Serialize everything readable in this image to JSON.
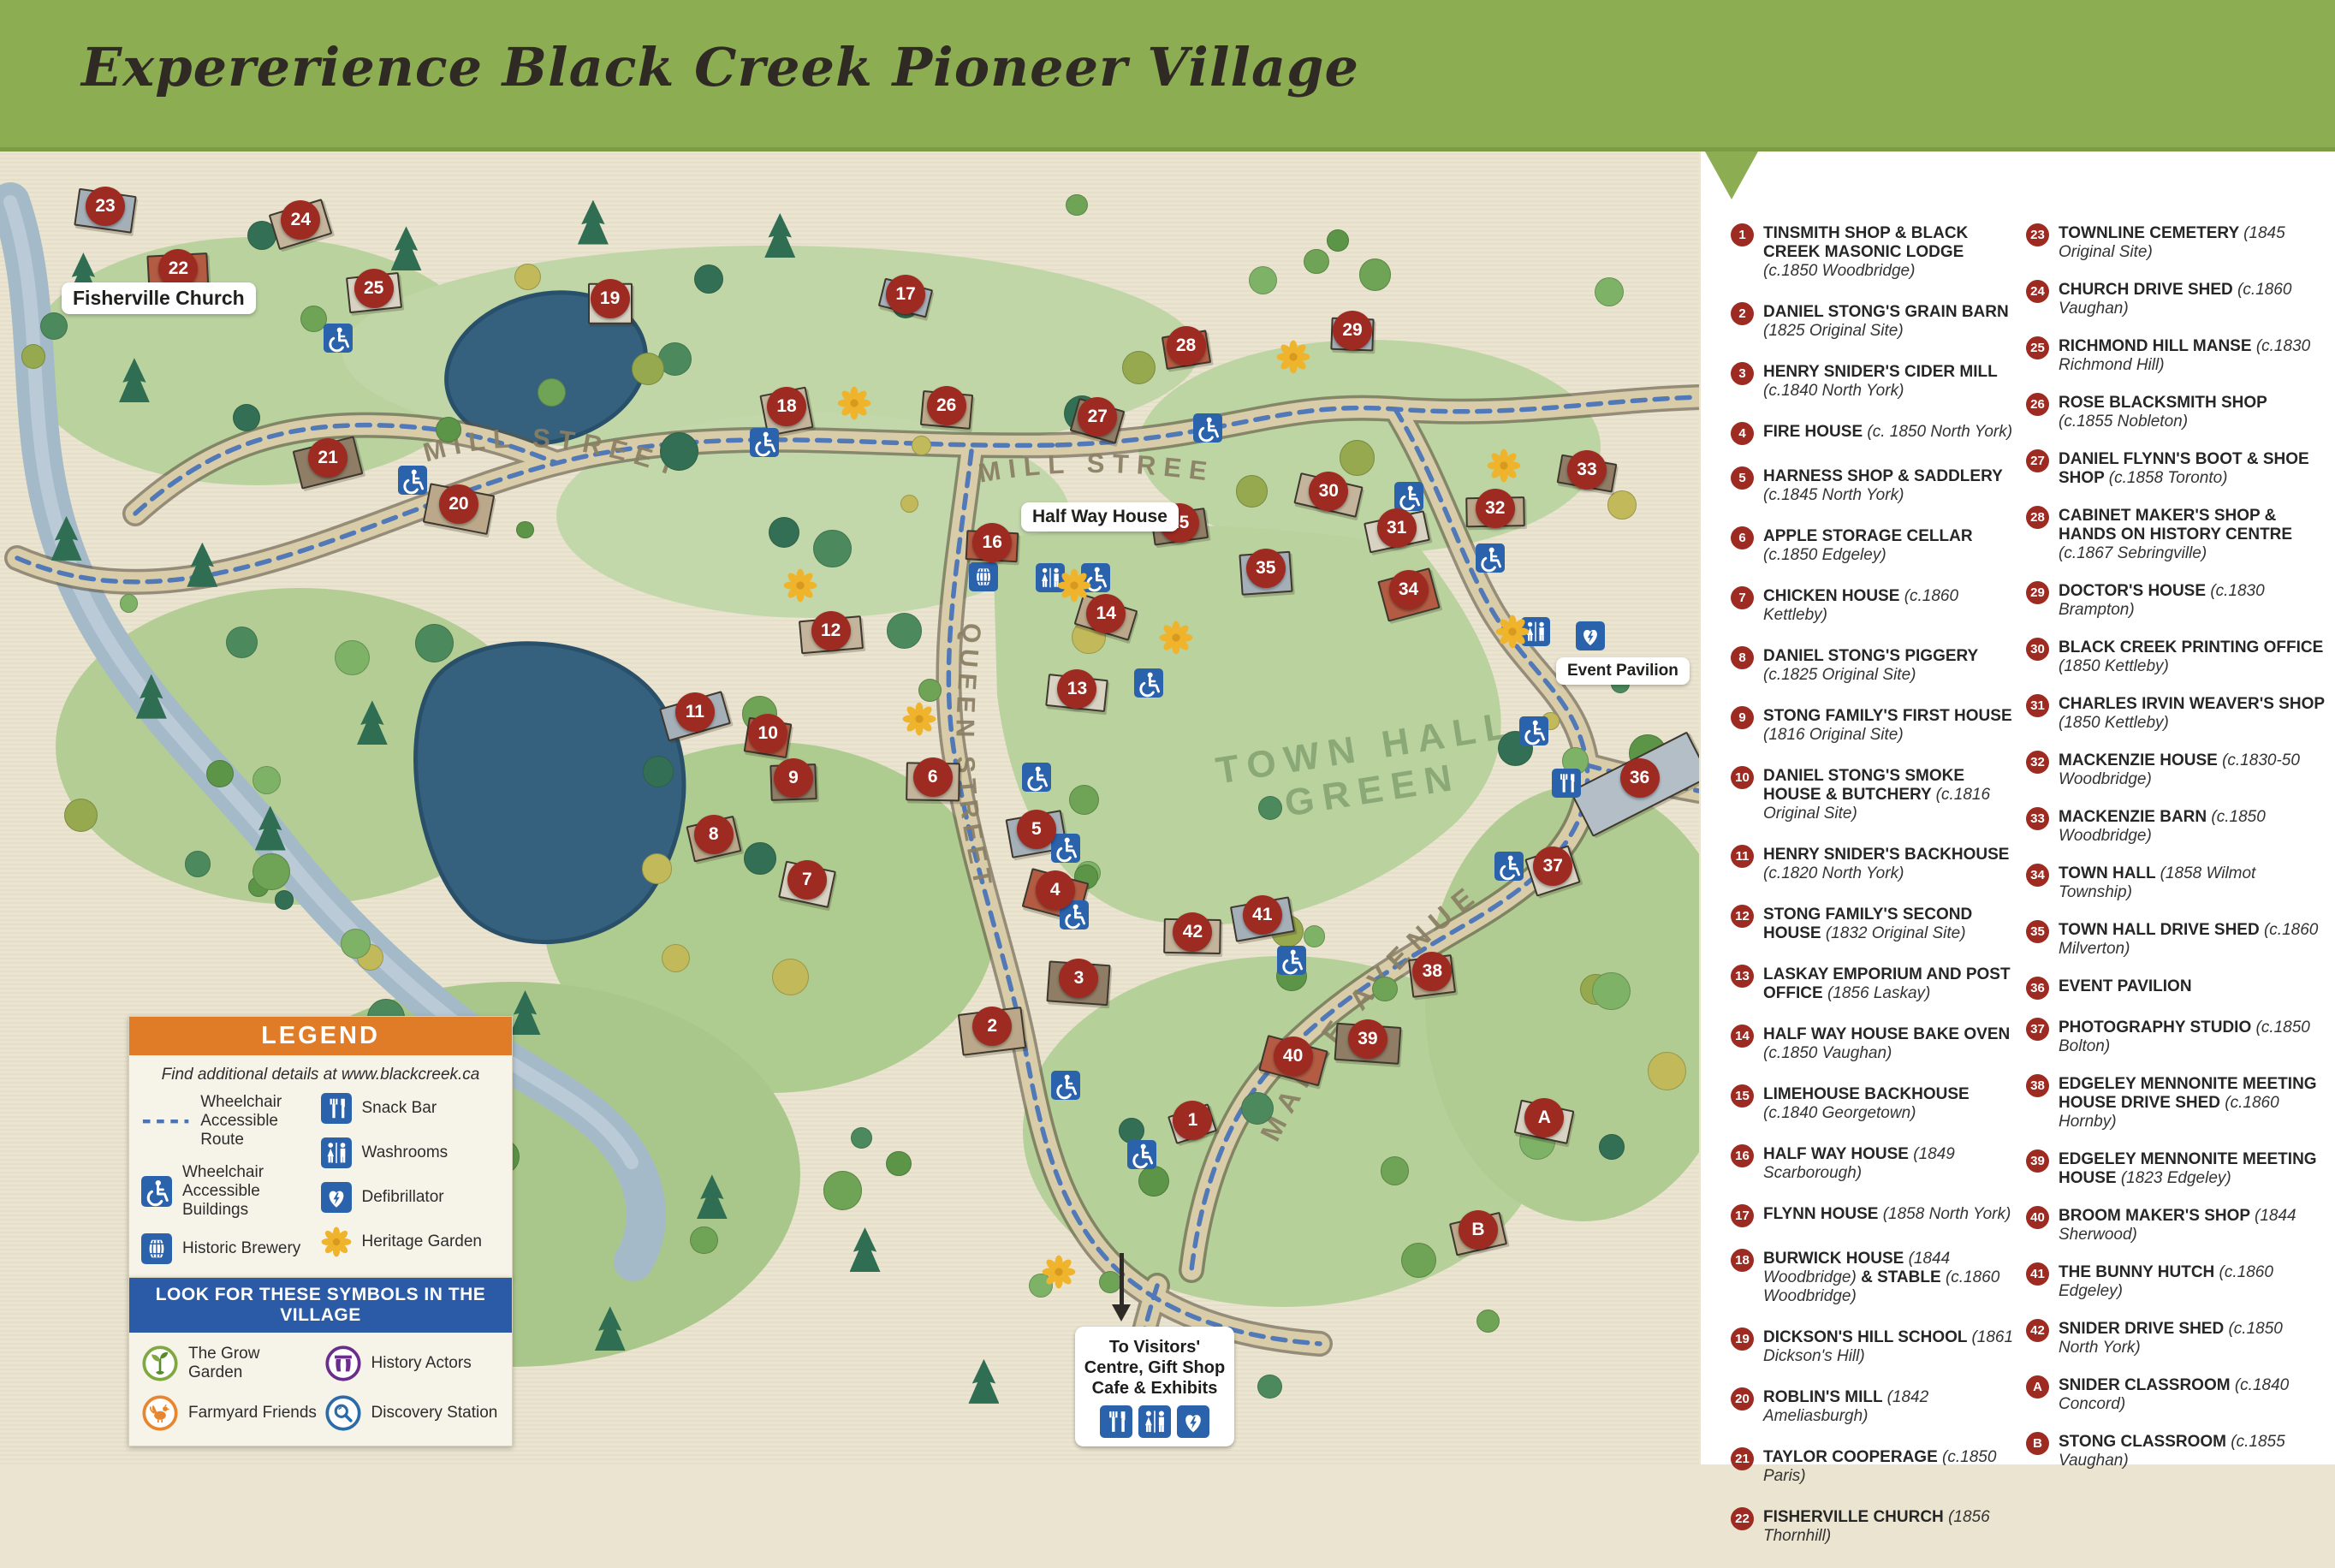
{
  "title": "Expererience Black Creek Pioneer Village",
  "colors": {
    "header_green": "#8CAD52",
    "marker_red": "#9E2B22",
    "icon_blue": "#2B62AC",
    "route_blue": "#4A74B8",
    "legend_orange": "#E07B27",
    "symbols_blue": "#2B5BA7",
    "heritage_yellow": "#EFB42C",
    "map_cream": "#EAE4D0",
    "road_tan": "#D9CDA9",
    "pond_blue": "#35617F",
    "river_blue": "#A4BAC9"
  },
  "map": {
    "streets": {
      "mill_left": "MILL STREET",
      "mill_center": "MILL STREET",
      "queen": "QUEEN STREET",
      "maple": "MAPLE AVENUE"
    },
    "green_label": [
      "TOWN HALL",
      "GREEN"
    ],
    "callouts": {
      "fisherville": "Fisherville Church",
      "halfway": "Half Way House",
      "event": "Event Pavilion"
    },
    "visitor_sign": {
      "lines": [
        "To Visitors'",
        "Centre, Gift Shop",
        "Cafe & Exhibits"
      ],
      "icons": [
        "snackbar",
        "washroom",
        "defib"
      ]
    },
    "markers": [
      {
        "id": "1",
        "x": 70.2,
        "y": 73.9
      },
      {
        "id": "2",
        "x": 58.4,
        "y": 66.7
      },
      {
        "id": "3",
        "x": 63.5,
        "y": 63.1
      },
      {
        "id": "4",
        "x": 62.1,
        "y": 56.4
      },
      {
        "id": "5",
        "x": 61.0,
        "y": 51.8
      },
      {
        "id": "6",
        "x": 54.9,
        "y": 47.8
      },
      {
        "id": "7",
        "x": 47.5,
        "y": 55.6
      },
      {
        "id": "8",
        "x": 42.0,
        "y": 52.2
      },
      {
        "id": "9",
        "x": 46.7,
        "y": 47.9
      },
      {
        "id": "10",
        "x": 45.2,
        "y": 44.5
      },
      {
        "id": "11",
        "x": 40.9,
        "y": 42.9
      },
      {
        "id": "12",
        "x": 48.9,
        "y": 36.7
      },
      {
        "id": "13",
        "x": 63.4,
        "y": 41.1
      },
      {
        "id": "14",
        "x": 65.1,
        "y": 35.4
      },
      {
        "id": "15",
        "x": 69.4,
        "y": 28.5
      },
      {
        "id": "16",
        "x": 58.4,
        "y": 30.0
      },
      {
        "id": "17",
        "x": 53.3,
        "y": 11.2
      },
      {
        "id": "18",
        "x": 46.3,
        "y": 19.7
      },
      {
        "id": "19",
        "x": 35.9,
        "y": 11.5
      },
      {
        "id": "20",
        "x": 27.0,
        "y": 27.1
      },
      {
        "id": "21",
        "x": 19.3,
        "y": 23.6
      },
      {
        "id": "22",
        "x": 10.5,
        "y": 9.2
      },
      {
        "id": "23",
        "x": 6.2,
        "y": 4.5
      },
      {
        "id": "24",
        "x": 17.7,
        "y": 5.5
      },
      {
        "id": "25",
        "x": 22.0,
        "y": 10.7
      },
      {
        "id": "26",
        "x": 55.7,
        "y": 19.6
      },
      {
        "id": "27",
        "x": 64.6,
        "y": 20.5
      },
      {
        "id": "28",
        "x": 69.8,
        "y": 15.1
      },
      {
        "id": "29",
        "x": 79.6,
        "y": 13.9
      },
      {
        "id": "30",
        "x": 78.2,
        "y": 26.1
      },
      {
        "id": "31",
        "x": 82.2,
        "y": 28.9
      },
      {
        "id": "32",
        "x": 88.0,
        "y": 27.4
      },
      {
        "id": "33",
        "x": 93.4,
        "y": 24.5
      },
      {
        "id": "34",
        "x": 82.9,
        "y": 33.6
      },
      {
        "id": "35",
        "x": 74.5,
        "y": 32.0
      },
      {
        "id": "36",
        "x": 96.5,
        "y": 47.9
      },
      {
        "id": "37",
        "x": 91.4,
        "y": 54.6
      },
      {
        "id": "38",
        "x": 84.3,
        "y": 62.6
      },
      {
        "id": "39",
        "x": 80.5,
        "y": 67.7
      },
      {
        "id": "40",
        "x": 76.1,
        "y": 69.0
      },
      {
        "id": "41",
        "x": 74.3,
        "y": 58.3
      },
      {
        "id": "42",
        "x": 70.2,
        "y": 59.6
      },
      {
        "id": "A",
        "x": 90.9,
        "y": 73.7
      },
      {
        "id": "B",
        "x": 87.0,
        "y": 82.2
      }
    ],
    "icons": {
      "wheelchair": [
        [
          19.9,
          14.5
        ],
        [
          24.3,
          25.3
        ],
        [
          45.0,
          22.4
        ],
        [
          71.1,
          21.3
        ],
        [
          82.9,
          26.5
        ],
        [
          87.7,
          31.2
        ],
        [
          64.5,
          32.7
        ],
        [
          67.6,
          40.7
        ],
        [
          61.0,
          47.8
        ],
        [
          62.7,
          53.2
        ],
        [
          63.2,
          58.3
        ],
        [
          90.3,
          44.3
        ],
        [
          88.8,
          54.6
        ],
        [
          62.7,
          71.2
        ],
        [
          67.2,
          76.5
        ],
        [
          76.0,
          61.7
        ]
      ],
      "washroom": [
        [
          61.8,
          32.7
        ],
        [
          90.4,
          36.8
        ]
      ],
      "brewery": [
        [
          57.9,
          32.6
        ]
      ],
      "defib": [
        [
          93.6,
          37.1
        ]
      ],
      "snackbar": [
        [
          92.2,
          48.3
        ]
      ],
      "heritage": [
        [
          50.3,
          19.4
        ],
        [
          47.1,
          33.3
        ],
        [
          54.1,
          43.4
        ],
        [
          63.2,
          33.3
        ],
        [
          69.2,
          37.2
        ],
        [
          88.5,
          24.2
        ],
        [
          89.0,
          36.8
        ],
        [
          62.3,
          85.4
        ],
        [
          76.1,
          15.9
        ]
      ]
    }
  },
  "legend": {
    "header": "LEGEND",
    "note": "Find additional details at www.blackcreek.ca",
    "left": [
      {
        "icon": "route",
        "label": "Wheelchair Accessible Route"
      },
      {
        "icon": "wheelchair",
        "label": "Wheelchair Accessible Buildings"
      },
      {
        "icon": "brewery",
        "label": "Historic Brewery"
      }
    ],
    "right": [
      {
        "icon": "snackbar",
        "label": "Snack Bar"
      },
      {
        "icon": "washroom",
        "label": "Washrooms"
      },
      {
        "icon": "defib",
        "label": "Defibrillator"
      },
      {
        "icon": "heritage",
        "label": "Heritage Garden"
      }
    ]
  },
  "symbols": {
    "header": "LOOK FOR THESE SYMBOLS IN THE VILLAGE",
    "items": [
      {
        "icon": "grow",
        "label": "The Grow Garden"
      },
      {
        "icon": "actors",
        "label": "History Actors"
      },
      {
        "icon": "farmyard",
        "label": "Farmyard Friends"
      },
      {
        "icon": "discovery",
        "label": "Discovery Station"
      }
    ]
  },
  "directory": {
    "column1": [
      {
        "id": "1",
        "parts": [
          [
            "TINSMITH SHOP & BLACK CREEK MASONIC LODGE",
            "b"
          ],
          [
            "(c.1850 Woodbridge)",
            "i"
          ]
        ]
      },
      {
        "id": "2",
        "parts": [
          [
            "DANIEL STONG'S GRAIN BARN",
            "b"
          ],
          [
            "(1825 Original Site)",
            "i"
          ]
        ]
      },
      {
        "id": "3",
        "parts": [
          [
            "HENRY SNIDER'S CIDER MILL",
            "b"
          ],
          [
            "(c.1840 North York)",
            "i"
          ]
        ]
      },
      {
        "id": "4",
        "parts": [
          [
            "FIRE HOUSE",
            "b"
          ],
          [
            "(c. 1850 North York)",
            "i"
          ]
        ]
      },
      {
        "id": "5",
        "parts": [
          [
            "HARNESS SHOP & SADDLERY",
            "b"
          ],
          [
            "(c.1845 North York)",
            "i"
          ]
        ]
      },
      {
        "id": "6",
        "parts": [
          [
            "APPLE STORAGE CELLAR",
            "b"
          ],
          [
            "(c.1850 Edgeley)",
            "i"
          ]
        ]
      },
      {
        "id": "7",
        "parts": [
          [
            "CHICKEN HOUSE",
            "b"
          ],
          [
            "(c.1860 Kettleby)",
            "i"
          ]
        ]
      },
      {
        "id": "8",
        "parts": [
          [
            "DANIEL STONG'S PIGGERY",
            "b"
          ],
          [
            "(c.1825 Original Site)",
            "i"
          ]
        ]
      },
      {
        "id": "9",
        "parts": [
          [
            "STONG FAMILY'S FIRST HOUSE",
            "b"
          ],
          [
            "(1816 Original Site)",
            "i"
          ]
        ]
      },
      {
        "id": "10",
        "parts": [
          [
            "DANIEL STONG'S SMOKE HOUSE & BUTCHERY",
            "b"
          ],
          [
            "(c.1816 Original Site)",
            "i"
          ]
        ]
      },
      {
        "id": "11",
        "parts": [
          [
            "HENRY SNIDER'S BACKHOUSE",
            "b"
          ],
          [
            "(c.1820 North York)",
            "i"
          ]
        ]
      },
      {
        "id": "12",
        "parts": [
          [
            "STONG FAMILY'S SECOND HOUSE",
            "b"
          ],
          [
            "(1832 Original Site)",
            "i"
          ]
        ]
      },
      {
        "id": "13",
        "parts": [
          [
            "LASKAY EMPORIUM AND POST OFFICE",
            "b"
          ],
          [
            "(1856 Laskay)",
            "i"
          ]
        ]
      },
      {
        "id": "14",
        "parts": [
          [
            "HALF WAY HOUSE BAKE OVEN",
            "b"
          ],
          [
            "(c.1850 Vaughan)",
            "i"
          ]
        ]
      },
      {
        "id": "15",
        "parts": [
          [
            "LIMEHOUSE BACKHOUSE",
            "b"
          ],
          [
            "(c.1840 Georgetown)",
            "i"
          ]
        ]
      },
      {
        "id": "16",
        "parts": [
          [
            "HALF WAY HOUSE",
            "b"
          ],
          [
            "(1849 Scarborough)",
            "i"
          ]
        ]
      },
      {
        "id": "17",
        "parts": [
          [
            "FLYNN HOUSE",
            "b"
          ],
          [
            "(1858 North York)",
            "i"
          ]
        ]
      },
      {
        "id": "18",
        "parts": [
          [
            "BURWICK HOUSE",
            "b"
          ],
          [
            "(1844 Woodbridge)",
            "i"
          ],
          [
            "& STABLE",
            "b"
          ],
          [
            "(c.1860 Woodbridge)",
            "i"
          ]
        ]
      },
      {
        "id": "19",
        "parts": [
          [
            "DICKSON'S HILL SCHOOL",
            "b"
          ],
          [
            "(1861 Dickson's Hill)",
            "i"
          ]
        ]
      },
      {
        "id": "20",
        "parts": [
          [
            "ROBLIN'S MILL",
            "b"
          ],
          [
            "(1842 Ameliasburgh)",
            "i"
          ]
        ]
      },
      {
        "id": "21",
        "parts": [
          [
            "TAYLOR COOPERAGE",
            "b"
          ],
          [
            "(c.1850 Paris)",
            "i"
          ]
        ]
      },
      {
        "id": "22",
        "parts": [
          [
            "FISHERVILLE CHURCH",
            "b"
          ],
          [
            "(1856 Thornhill)",
            "i"
          ]
        ]
      }
    ],
    "column2": [
      {
        "id": "23",
        "parts": [
          [
            "TOWNLINE CEMETERY",
            "b"
          ],
          [
            "(1845 Original Site)",
            "i"
          ]
        ]
      },
      {
        "id": "24",
        "parts": [
          [
            "CHURCH DRIVE SHED",
            "b"
          ],
          [
            "(c.1860 Vaughan)",
            "i"
          ]
        ]
      },
      {
        "id": "25",
        "parts": [
          [
            "RICHMOND HILL MANSE",
            "b"
          ],
          [
            "(c.1830 Richmond Hill)",
            "i"
          ]
        ]
      },
      {
        "id": "26",
        "parts": [
          [
            "ROSE BLACKSMITH SHOP",
            "b"
          ],
          [
            "(c.1855 Nobleton)",
            "i"
          ]
        ]
      },
      {
        "id": "27",
        "parts": [
          [
            "DANIEL FLYNN'S BOOT & SHOE SHOP",
            "b"
          ],
          [
            "(c.1858 Toronto)",
            "i"
          ]
        ]
      },
      {
        "id": "28",
        "parts": [
          [
            "CABINET MAKER'S SHOP & HANDS ON HISTORY CENTRE",
            "b"
          ],
          [
            "(c.1867 Sebringville)",
            "i"
          ]
        ]
      },
      {
        "id": "29",
        "parts": [
          [
            "DOCTOR'S HOUSE",
            "b"
          ],
          [
            "(c.1830 Brampton)",
            "i"
          ]
        ]
      },
      {
        "id": "30",
        "parts": [
          [
            "BLACK CREEK PRINTING OFFICE",
            "b"
          ],
          [
            "(1850 Kettleby)",
            "i"
          ]
        ]
      },
      {
        "id": "31",
        "parts": [
          [
            "CHARLES IRVIN WEAVER'S SHOP",
            "b"
          ],
          [
            "(1850 Kettleby)",
            "i"
          ]
        ]
      },
      {
        "id": "32",
        "parts": [
          [
            "MACKENZIE HOUSE",
            "b"
          ],
          [
            "(c.1830-50 Woodbridge)",
            "i"
          ]
        ]
      },
      {
        "id": "33",
        "parts": [
          [
            "MACKENZIE BARN",
            "b"
          ],
          [
            "(c.1850 Woodbridge)",
            "i"
          ]
        ]
      },
      {
        "id": "34",
        "parts": [
          [
            "TOWN HALL",
            "b"
          ],
          [
            "(1858 Wilmot Township)",
            "i"
          ]
        ]
      },
      {
        "id": "35",
        "parts": [
          [
            "TOWN HALL DRIVE SHED",
            "b"
          ],
          [
            "(c.1860 Milverton)",
            "i"
          ]
        ]
      },
      {
        "id": "36",
        "parts": [
          [
            "EVENT PAVILION",
            "b"
          ]
        ]
      },
      {
        "id": "37",
        "parts": [
          [
            "PHOTOGRAPHY STUDIO",
            "b"
          ],
          [
            "(c.1850 Bolton)",
            "i"
          ]
        ]
      },
      {
        "id": "38",
        "parts": [
          [
            "EDGELEY MENNONITE MEETING HOUSE DRIVE SHED",
            "b"
          ],
          [
            "(c.1860 Hornby)",
            "i"
          ]
        ]
      },
      {
        "id": "39",
        "parts": [
          [
            "EDGELEY MENNONITE MEETING HOUSE",
            "b"
          ],
          [
            "(1823 Edgeley)",
            "i"
          ]
        ]
      },
      {
        "id": "40",
        "parts": [
          [
            "BROOM MAKER'S SHOP",
            "b"
          ],
          [
            "(1844 Sherwood)",
            "i"
          ]
        ]
      },
      {
        "id": "41",
        "parts": [
          [
            "THE BUNNY HUTCH",
            "b"
          ],
          [
            "(c.1860 Edgeley)",
            "i"
          ]
        ]
      },
      {
        "id": "42",
        "parts": [
          [
            "SNIDER DRIVE SHED",
            "b"
          ],
          [
            "(c.1850 North York)",
            "i"
          ]
        ]
      },
      {
        "id": "A",
        "parts": [
          [
            "SNIDER CLASSROOM",
            "b"
          ],
          [
            "(c.1840 Concord)",
            "i"
          ]
        ]
      },
      {
        "id": "B",
        "parts": [
          [
            "STONG CLASSROOM",
            "b"
          ],
          [
            "(c.1855 Vaughan)",
            "i"
          ]
        ]
      }
    ]
  }
}
